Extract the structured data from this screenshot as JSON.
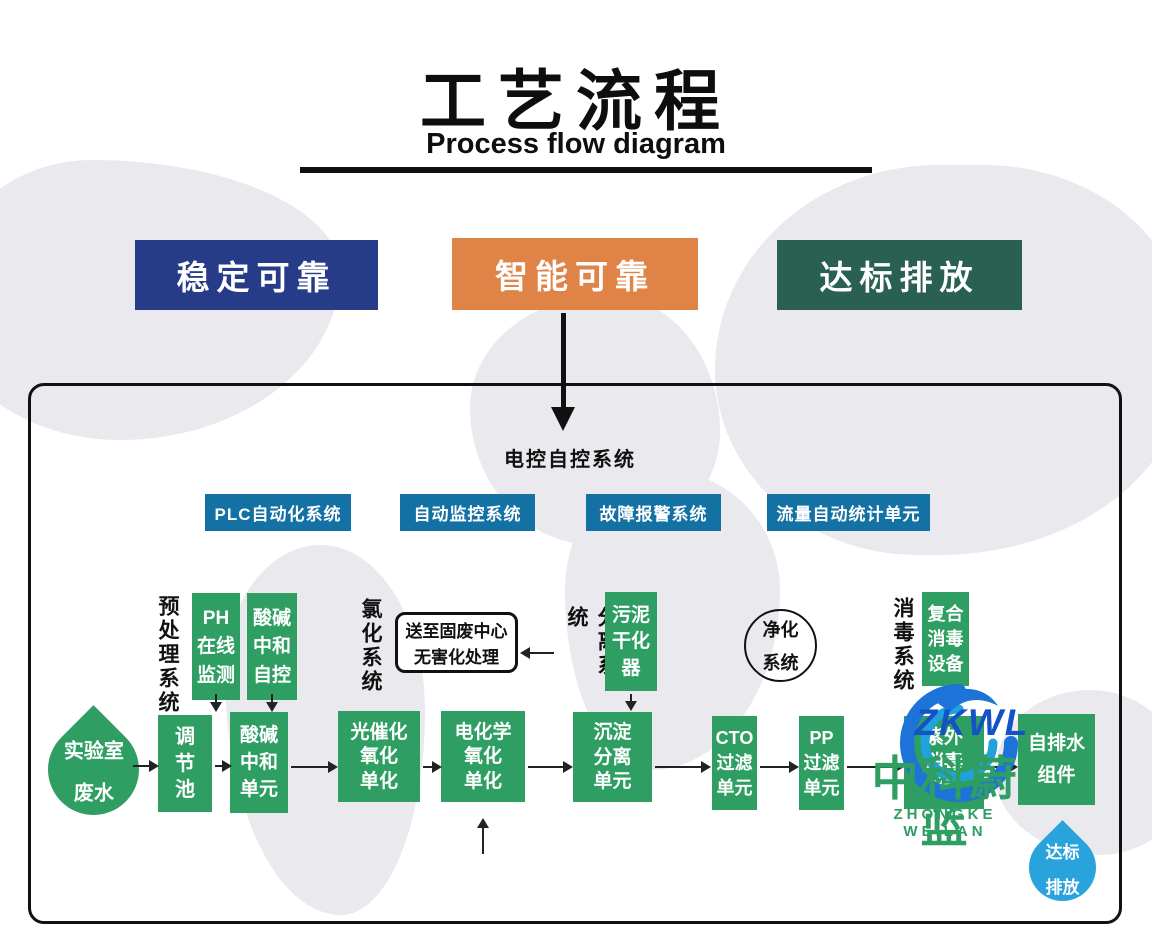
{
  "page": {
    "title_zh": "工艺流程",
    "title_en": "Process flow diagram"
  },
  "badges": [
    {
      "label": "稳定可靠",
      "color": "#263c88"
    },
    {
      "label": "智能可靠",
      "color": "#e08347"
    },
    {
      "label": "达标排放",
      "color": "#2a6052"
    }
  ],
  "control": {
    "title": "电控自控系统",
    "box_color": "#1471a3",
    "subsystems": [
      {
        "label": "PLC自动化系统"
      },
      {
        "label": "自动监控系统"
      },
      {
        "label": "故障报警系统"
      },
      {
        "label": "流量自动统计单元"
      }
    ]
  },
  "sections": {
    "pretreatment": "预处理系统",
    "chlorination": "氯化系统",
    "separation": "分离系统",
    "purification_l1": "净化",
    "purification_l2": "系统",
    "disinfection": "消毒系统"
  },
  "units": {
    "unit_color": "#2e9e63",
    "source_drop": {
      "l1": "实验室",
      "l2": "废水"
    },
    "ph_monitor": {
      "l1": "PH",
      "l2": "在线",
      "l3": "监测"
    },
    "acid_base_control": {
      "l1": "酸碱",
      "l2": "中和",
      "l3": "自控"
    },
    "regulating_tank": {
      "l1": "调",
      "l2": "节",
      "l3": "池"
    },
    "acid_base_unit": {
      "l1": "酸碱",
      "l2": "中和",
      "l3": "单元"
    },
    "photocatalytic_unit": {
      "l1": "光催化",
      "l2": "氧化",
      "l3": "单化"
    },
    "electrochemical_unit": {
      "l1": "电化学",
      "l2": "氧化",
      "l3": "单化"
    },
    "sludge_dryer": {
      "l1": "污泥",
      "l2": "干化",
      "l3": "器"
    },
    "sedimentation_unit": {
      "l1": "沉淀",
      "l2": "分离",
      "l3": "单元"
    },
    "cto_filter": {
      "l1": "CTO",
      "l2": "过滤",
      "l3": "单元"
    },
    "pp_filter": {
      "l1": "PP",
      "l2": "过滤",
      "l3": "单元"
    },
    "composite_disinfection": {
      "l1": "复合",
      "l2": "消毒",
      "l3": "设备"
    },
    "uv_disinfection": {
      "l1": "紫外",
      "l2": "消毒",
      "l3": "单元"
    },
    "self_drain": {
      "l1": "自排水",
      "l2": "组件"
    },
    "solid_waste_note": {
      "l1": "送至固废中心",
      "l2": "无害化处理"
    },
    "outlet_drop": {
      "l1": "达标",
      "l2": "排放",
      "color": "#29a3dc"
    }
  },
  "watermark": {
    "logo": "ZKWL",
    "name_zh": "中科蔚蓝",
    "name_en": "ZHONGKE WEILAN",
    "blue": "#1453c6",
    "green": "#2e9e63"
  }
}
